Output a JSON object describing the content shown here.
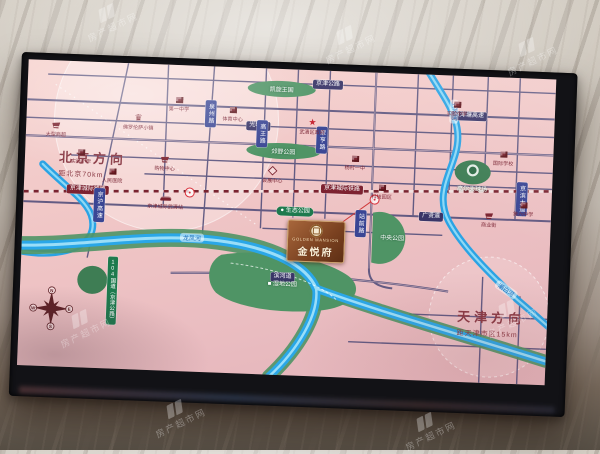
{
  "photo": {
    "watermark": {
      "text": "房产超市网"
    }
  },
  "map": {
    "directions": {
      "beijing": {
        "title": "北京方向",
        "subtitle": "距北京70km"
      },
      "tianjin": {
        "title": "天津方向",
        "subtitle": "距天津市区15km"
      }
    },
    "project": {
      "name_en": "GOLDEN MANSION",
      "name_cn": "金悦府"
    },
    "compass": {
      "n": "N",
      "e": "E",
      "s": "S",
      "w": "W"
    },
    "road_pills_h": [
      {
        "label": "京津公路"
      },
      {
        "label": "京津塘高速"
      },
      {
        "label": "光明道"
      },
      {
        "label": "广贤道"
      },
      {
        "label": "滨河道"
      }
    ],
    "railway": {
      "label": "京津城际铁路"
    },
    "road_pills_v": [
      {
        "label": "京沪高速"
      },
      {
        "label": "泉州路"
      },
      {
        "label": "高王路"
      },
      {
        "label": "翠亨路"
      },
      {
        "label": "站前路"
      },
      {
        "label": "京滨大道"
      }
    ],
    "national_road": {
      "label": "104国道（京津公路）"
    },
    "rivers": [
      {
        "label": "龙凤河"
      },
      {
        "label": "北运河"
      },
      {
        "label": "潮白河"
      }
    ],
    "parks": [
      {
        "label": "凯旋王国"
      },
      {
        "label": "郊野公园"
      },
      {
        "label": "生态公园"
      },
      {
        "label": "湿地公园"
      },
      {
        "label": "中央公园"
      },
      {
        "label": "高尔夫球场"
      }
    ],
    "pois": [
      {
        "icon": "cart",
        "label": "大型商超"
      },
      {
        "icon": "building",
        "label": "实验小学"
      },
      {
        "icon": "crown",
        "label": "佛罗伦萨小镇"
      },
      {
        "icon": "building",
        "label": "第一中学"
      },
      {
        "icon": "building",
        "label": "人民医院"
      },
      {
        "icon": "cart",
        "label": "购物中心"
      },
      {
        "icon": "building",
        "label": "体育中心"
      },
      {
        "icon": "train",
        "label": "京津城际武清站"
      },
      {
        "icon": "diamond",
        "label": "会展中心"
      },
      {
        "icon": "star",
        "label": "武清区政府"
      },
      {
        "icon": "building",
        "label": "杨村一中"
      },
      {
        "icon": "building",
        "label": "科技园区"
      },
      {
        "icon": "building",
        "label": "实验中学"
      },
      {
        "icon": "building",
        "label": "国际学校"
      },
      {
        "icon": "cart",
        "label": "商业街"
      },
      {
        "icon": "building",
        "label": "第六中学"
      }
    ]
  },
  "icons": {
    "crown": "♛",
    "star": "★",
    "park_dot": "●",
    "park_flag": "■"
  },
  "colors": {
    "map_bg": "#f0c6c6",
    "road": "#57527d",
    "river": "#2aa7e8",
    "park": "#4f9465",
    "pill_navy": "#3a3668",
    "pill_blue": "#3a4694",
    "pill_green": "#1e7a4e",
    "railway_red": "#7d2230",
    "logo_brown": "#7a4120",
    "direction_text": "#8a3a45"
  }
}
